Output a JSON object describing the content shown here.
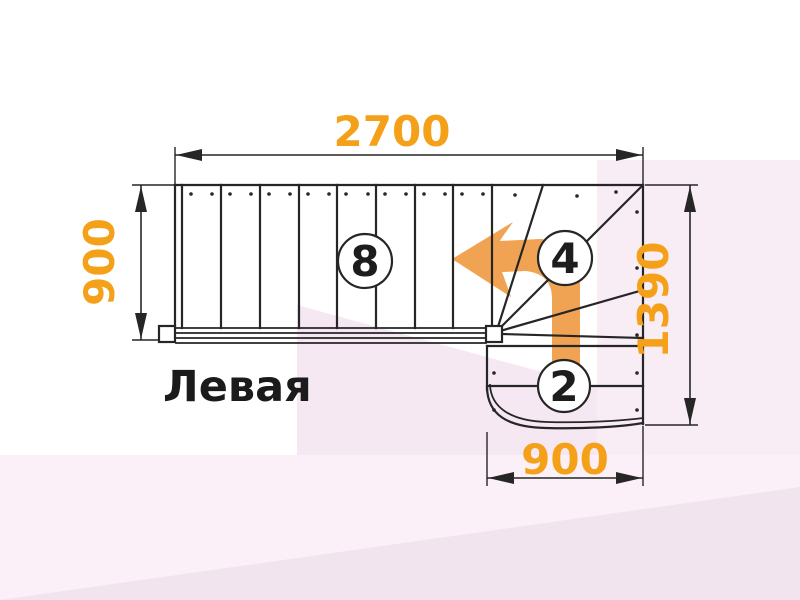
{
  "diagram": {
    "type": "staircase-floor-plan",
    "title": "Левая",
    "dimensions": {
      "top_width": "2700",
      "left_height": "900",
      "right_height": "1390",
      "bottom_width": "900"
    },
    "step_counts": {
      "main_flight": "8",
      "winder_steps": "4",
      "lower_flight": "2"
    },
    "icons": {
      "direction_arrow": "turn-left-arrow"
    },
    "colors": {
      "dimension_text": "#F5A019",
      "arrow_fill": "#F0A352",
      "line": "#262626",
      "background_pink_1": "#F8ECF5",
      "background_pink_2": "#F6E8F2",
      "background_pink_3": "#FBF0F7",
      "background_pink_4": "#F1E4EE"
    }
  }
}
